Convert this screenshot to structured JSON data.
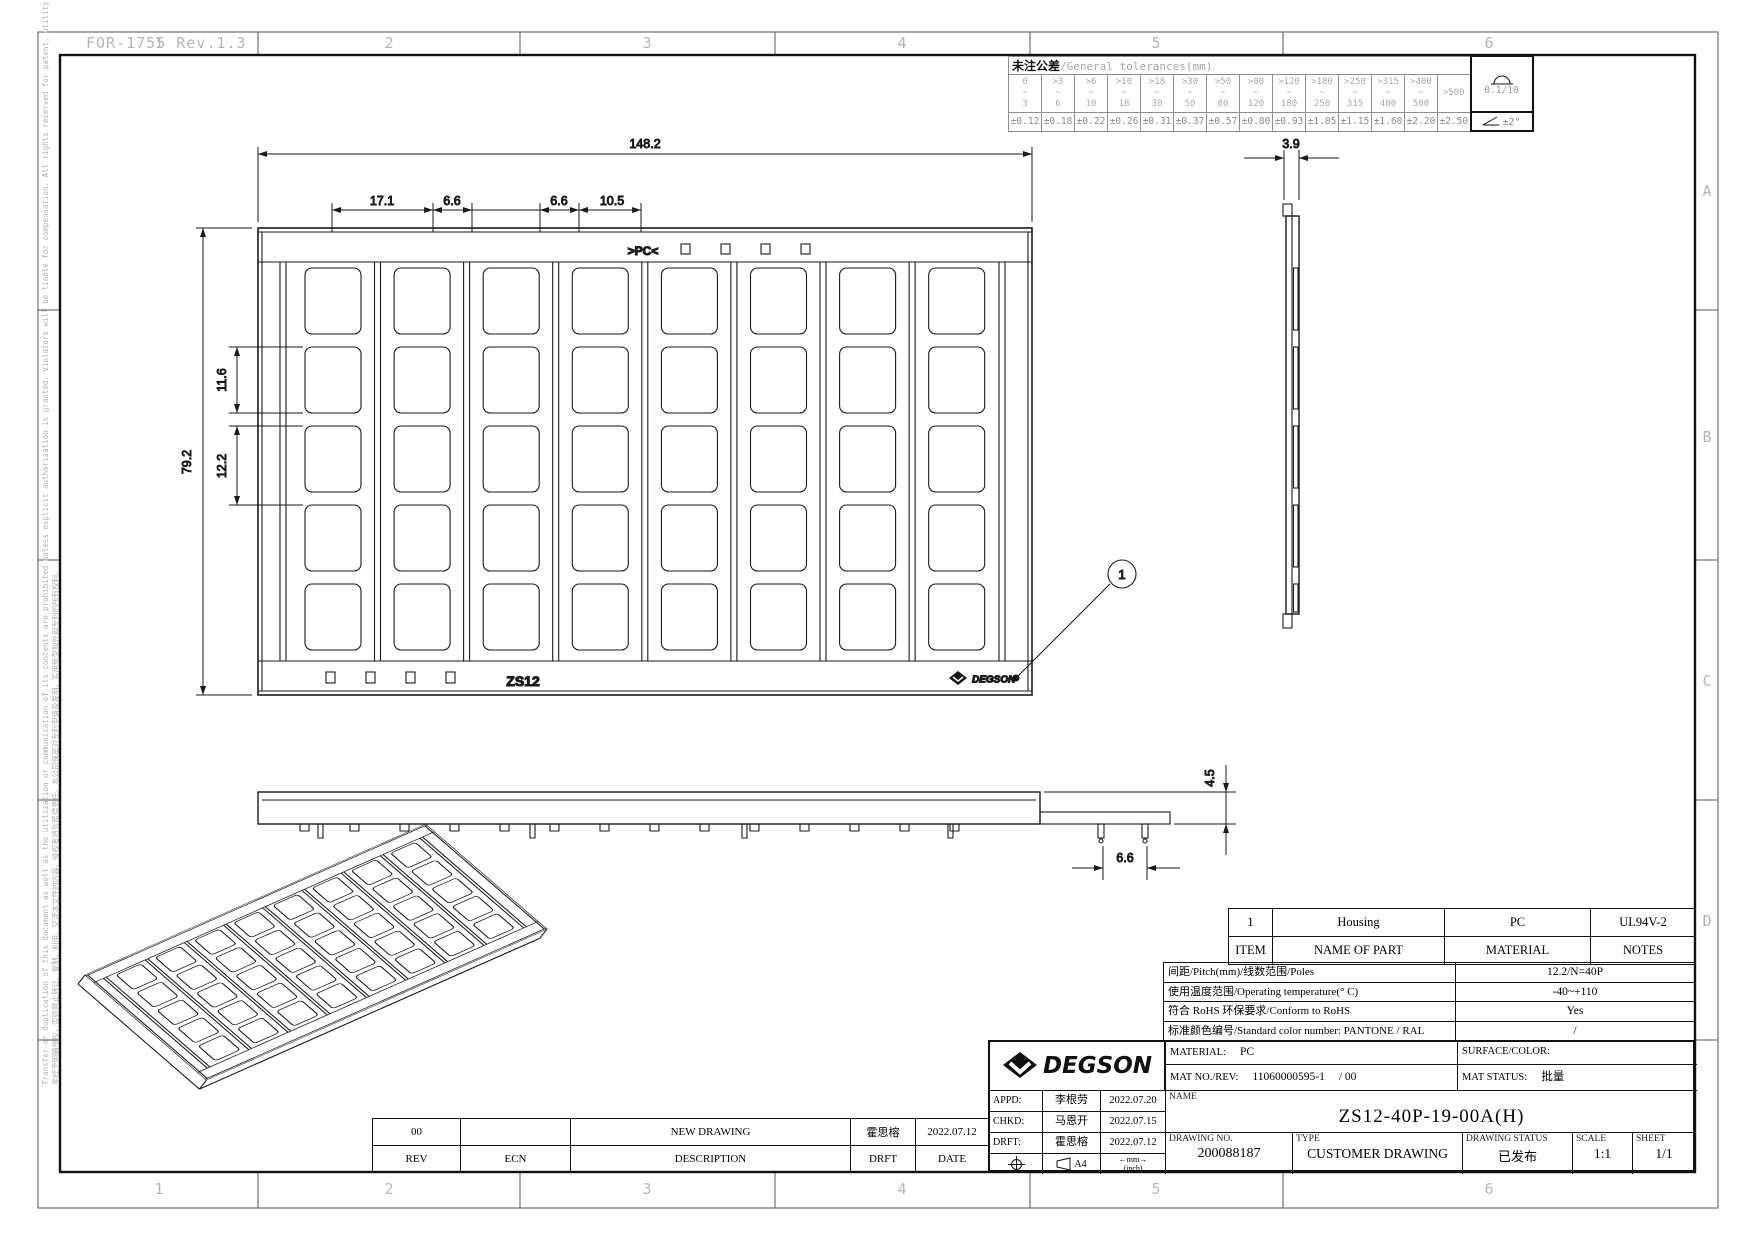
{
  "frame": {
    "form_label": "FOR-1755 Rev.1.3",
    "zone_columns": [
      "1",
      "2",
      "3",
      "4",
      "5",
      "6"
    ],
    "zone_rows": [
      "A",
      "B",
      "C",
      "D"
    ]
  },
  "legal_notice": {
    "en": "Transfer or duplication of this document as well as the utilization or communication of its contents are prohibited unless explicit authorization is granted. Violators will be liable for compensation. All rights reserved for patent, utility model or designs registrations.",
    "cn": "非经予明确授权，否则禁止转让、复制、利用、交流本文件的内容，侵权者将负赔偿责任。本公司保留对专利申请及发明、实用新型和外观专利的所有权利。"
  },
  "tolerances": {
    "title_cn": "未注公差",
    "title_en": "/General tolerances(mm)",
    "ranges": [
      "0\n~\n3",
      ">3\n~\n6",
      ">6\n~\n10",
      ">10\n~\n18",
      ">18\n~\n30",
      ">30\n~\n50",
      ">50\n~\n80",
      ">80\n~\n120",
      ">120\n~\n180",
      ">180\n~\n250",
      ">250\n~\n315",
      ">315\n~\n400",
      ">400\n~\n500",
      ">500"
    ],
    "values": [
      "±0.12",
      "±0.18",
      "±0.22",
      "±0.26",
      "±0.31",
      "±0.37",
      "±0.57",
      "±0.80",
      "±0.93",
      "±1.05",
      "±1.15",
      "±1.60",
      "±2.20",
      "±2.50"
    ],
    "flatness": "0.1/10",
    "angle": "±2°"
  },
  "views": {
    "front": {
      "pc_marking": ">PC<",
      "part_marking": "ZS12",
      "logo": "DEGSON",
      "balloon": "1"
    },
    "dimensions": {
      "total_width": "148.2",
      "seg_a": "17.1",
      "seg_b": "6.6",
      "seg_c": "6.6",
      "seg_d": "10.5",
      "total_height": "79.2",
      "window_height": "11.6",
      "row_pitch": "12.2",
      "side_width": "3.9",
      "base_height": "4.5",
      "base_slot": "6.6"
    }
  },
  "item_table": {
    "headers": [
      "ITEM",
      "NAME OF PART",
      "MATERIAL",
      "NOTES"
    ],
    "rows": [
      [
        "1",
        "Housing",
        "PC",
        "UL94V-2"
      ]
    ]
  },
  "specs": {
    "rows": [
      {
        "label": "间距/Pitch(mm)/线数范围/Poles",
        "value": "12.2/N=40P"
      },
      {
        "label": "使用温度范围/Operating temperature(° C)",
        "value": "-40~+110"
      },
      {
        "label": "符合 RoHS 环保要求/Conform to RoHS",
        "value": "Yes"
      },
      {
        "label": "标准颜色编号/Standard color number: PANTONE / RAL",
        "value": "/"
      }
    ]
  },
  "title_block": {
    "logo": "DEGSON",
    "material_label": "MATERIAL:",
    "material": "PC",
    "surface_label": "SURFACE/COLOR:",
    "mat_no_label": "MAT NO./REV:",
    "mat_no": "11060000595-1",
    "mat_rev": "/ 00",
    "mat_status_label": "MAT STATUS:",
    "mat_status": "批量",
    "name_label": "NAME",
    "name": "ZS12-40P-19-00A(H)",
    "drawing_no_label": "DRAWING NO.",
    "drawing_no": "200088187",
    "type_label": "TYPE",
    "type": "CUSTOMER DRAWING",
    "status_label": "DRAWING STATUS",
    "status": "已发布",
    "scale_label": "SCALE",
    "scale": "1:1",
    "sheet_label": "SHEET",
    "sheet": "1/1",
    "appd_label": "APPD:",
    "appd_name": "李根劳",
    "appd_date": "2022.07.20",
    "chkd_label": "CHKD:",
    "chkd_name": "马恩开",
    "chkd_date": "2022.07.15",
    "drft_label": "DRFT:",
    "drft_name": "霍思榕",
    "drft_date": "2022.07.12",
    "paper": "A4",
    "units_mm": "mm",
    "units_inch": "(inch)"
  },
  "revisions": {
    "headers": [
      "REV",
      "ECN",
      "DESCRIPTION",
      "DRFT",
      "DATE"
    ],
    "rows": [
      [
        "00",
        "",
        "NEW DRAWING",
        "霍思榕",
        "2022.07.12"
      ]
    ]
  }
}
